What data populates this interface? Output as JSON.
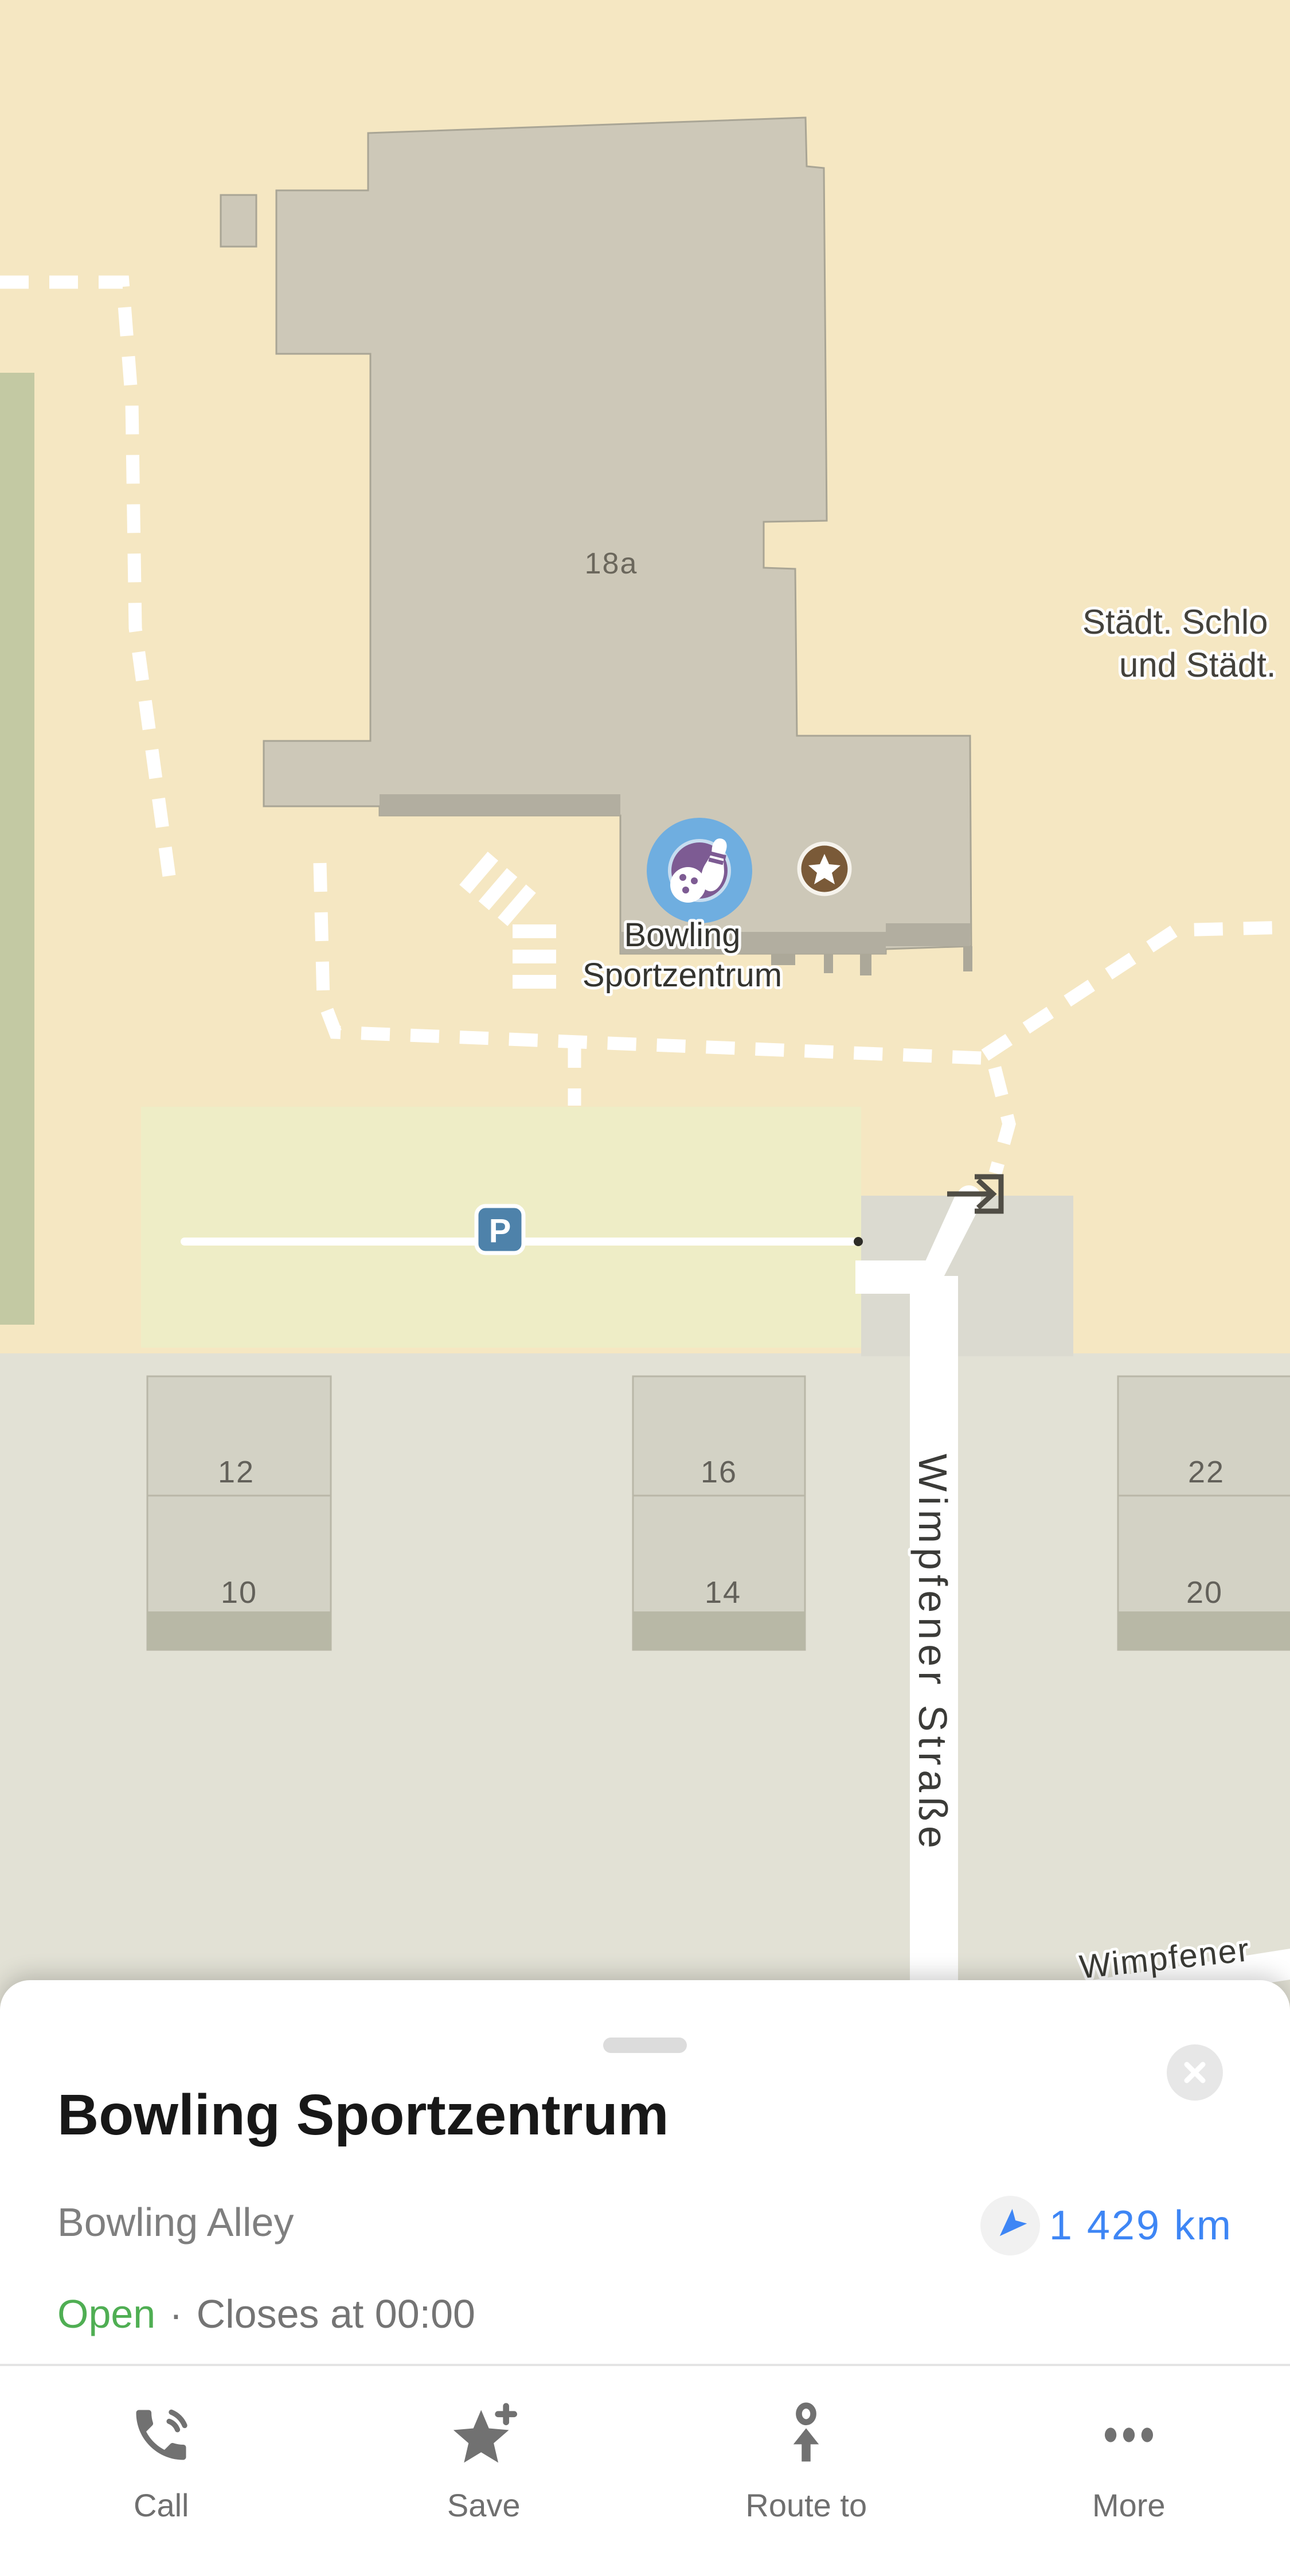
{
  "map": {
    "labels": {
      "building_number": "18a",
      "poi_line1": "Bowling",
      "poi_line2": "Sportzentrum",
      "district_line1": "Städt. Schlo",
      "district_line2": "und Städt.",
      "street_vertical": "Wimpfener Straße",
      "street_bottom": "Wimpfener",
      "parking_letter": "P",
      "house_12": "12",
      "house_10": "10",
      "house_16": "16",
      "house_14": "14",
      "house_22": "22",
      "house_20": "20"
    },
    "icons": {
      "selected_poi": "bowling-pin-and-ball-icon",
      "saved_place": "star-icon",
      "parking": "parking-p-icon",
      "entrance": "entrance-arrow-icon"
    },
    "colors": {
      "map_beige": "#F5E7C2",
      "building_gray": "#CDC8B8",
      "building_border": "#A9A595",
      "building_shadow": "#B2AEA0",
      "parking_fill": "#EEEDC6",
      "green_area": "#C3C9A3",
      "lower_area": "#E2E1D5",
      "house_fill": "#D3D2C5",
      "road_white": "#FFFFFF",
      "poi_halo_blue": "#6FAEE0",
      "poi_purple": "#7D5B93",
      "star_brown": "#7A5A38",
      "parking_sign_blue": "#4E82AA"
    }
  },
  "sheet": {
    "title": "Bowling Sportzentrum",
    "category": "Bowling Alley",
    "distance": "1 429 km",
    "status_open": "Open",
    "status_separator": "·",
    "status_closes": "Closes at 00:00",
    "colors": {
      "accent_blue": "#3E86F5",
      "open_green": "#4FAE53"
    },
    "actions": [
      {
        "label": "Call",
        "icon": "phone-icon"
      },
      {
        "label": "Save",
        "icon": "star-plus-icon"
      },
      {
        "label": "Route to",
        "icon": "route-arrow-icon"
      },
      {
        "label": "More",
        "icon": "ellipsis-icon"
      }
    ]
  }
}
